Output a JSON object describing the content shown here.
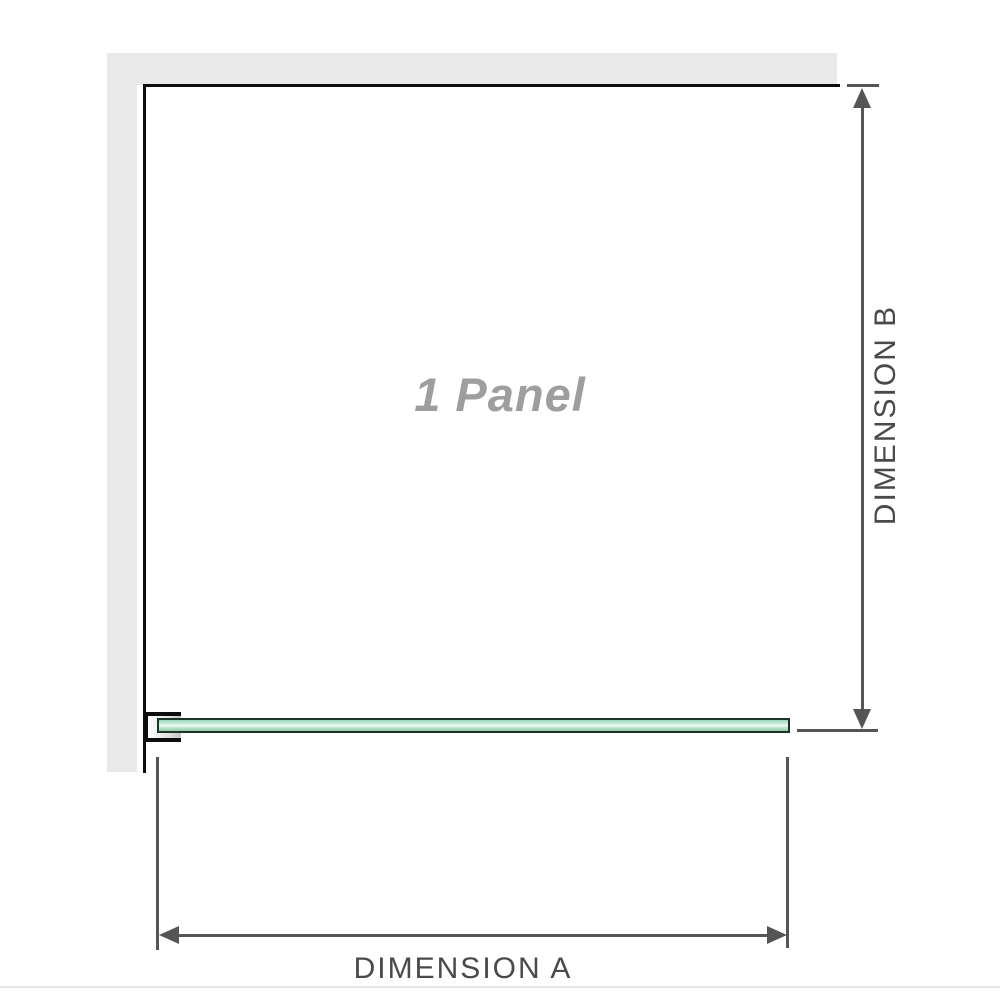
{
  "panel": {
    "label": "1 Panel"
  },
  "dimensions": {
    "a_label": "DIMENSION A",
    "b_label": "DIMENSION B"
  },
  "colors": {
    "wall": "#e9e9e9",
    "outline": "#0d0d0d",
    "dimension_line": "#555555",
    "dimension_text": "#4a4a4a",
    "panel_label": "#9e9e9e",
    "glass_border": "#1c3527",
    "glass_fill_light": "#eef9f2",
    "glass_fill_mid": "#9bd4b5",
    "baseline": "#e8e6e2"
  }
}
